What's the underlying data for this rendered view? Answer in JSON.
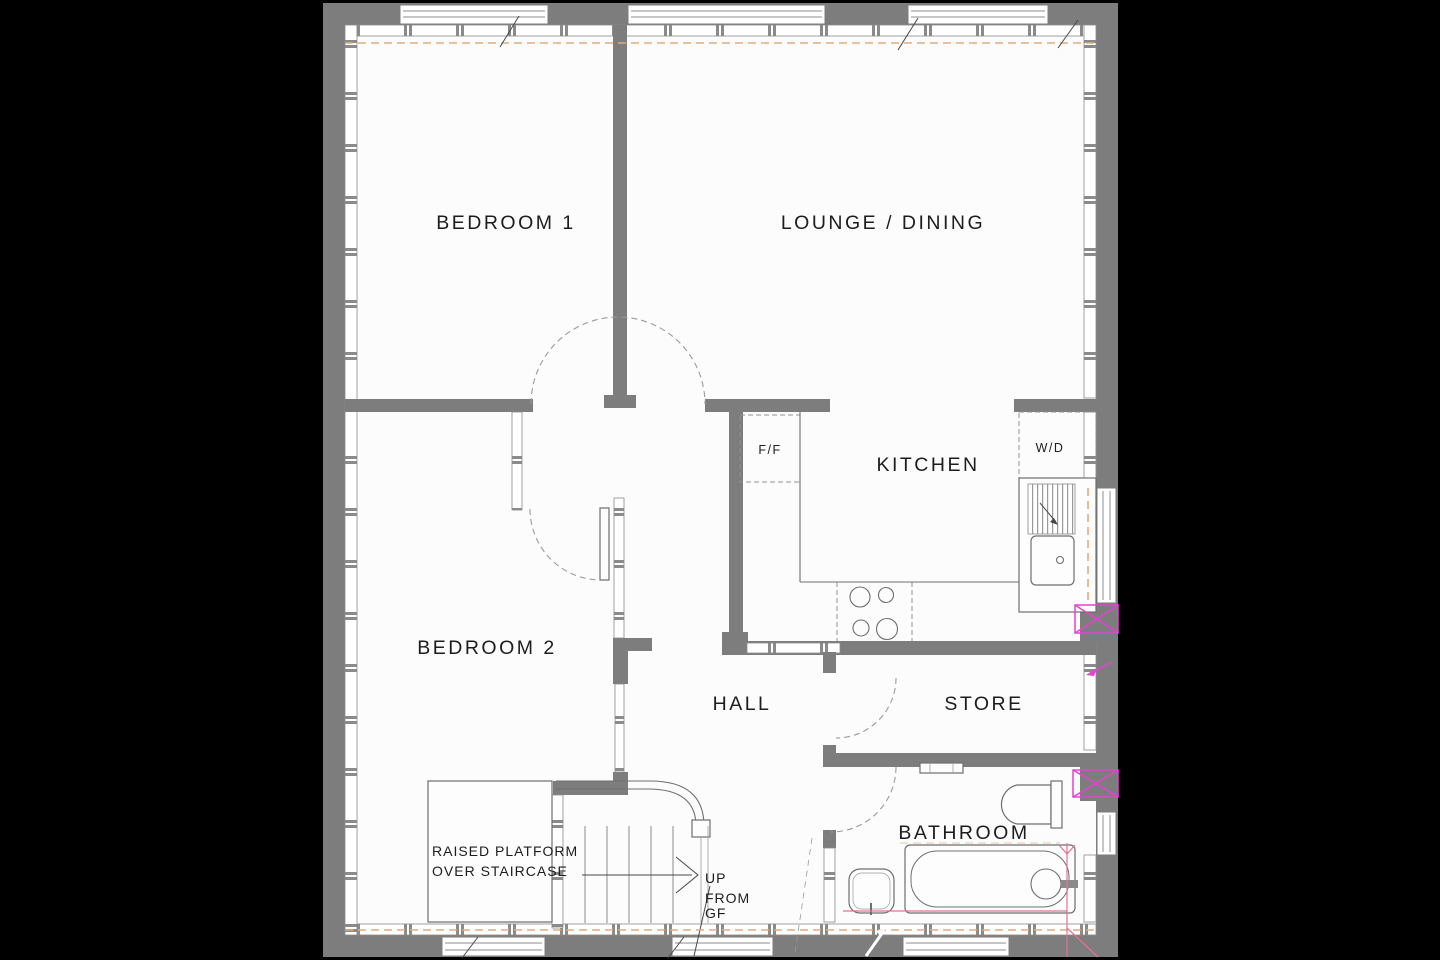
{
  "document": {
    "type": "floor-plan-drawing",
    "floor": "first floor flat"
  },
  "rooms": {
    "bedroom1": "BEDROOM 1",
    "lounge_dining": "LOUNGE / DINING",
    "kitchen": "KITCHEN",
    "bedroom2": "BEDROOM 2",
    "hall": "HALL",
    "store": "STORE",
    "bathroom": "BATHROOM"
  },
  "appliances": {
    "fridge_freezer": "F/F",
    "washer_dryer": "W/D"
  },
  "platform_note": {
    "line1": "RAISED PLATFORM",
    "line2": "OVER STAIRCASE"
  },
  "stair_note": {
    "line1": "UP",
    "line2": "FROM",
    "line3": "GF"
  },
  "colors": {
    "background": "#000000",
    "floor": "#fcfcfc",
    "wall": "#7d7d7d",
    "thin_line": "#6e6e6e",
    "datum_dash_orange": "#e2ab7d",
    "marker_magenta": "#e93fd5",
    "plumbing_pink": "#e8718f",
    "text": "#1d1d1d"
  }
}
